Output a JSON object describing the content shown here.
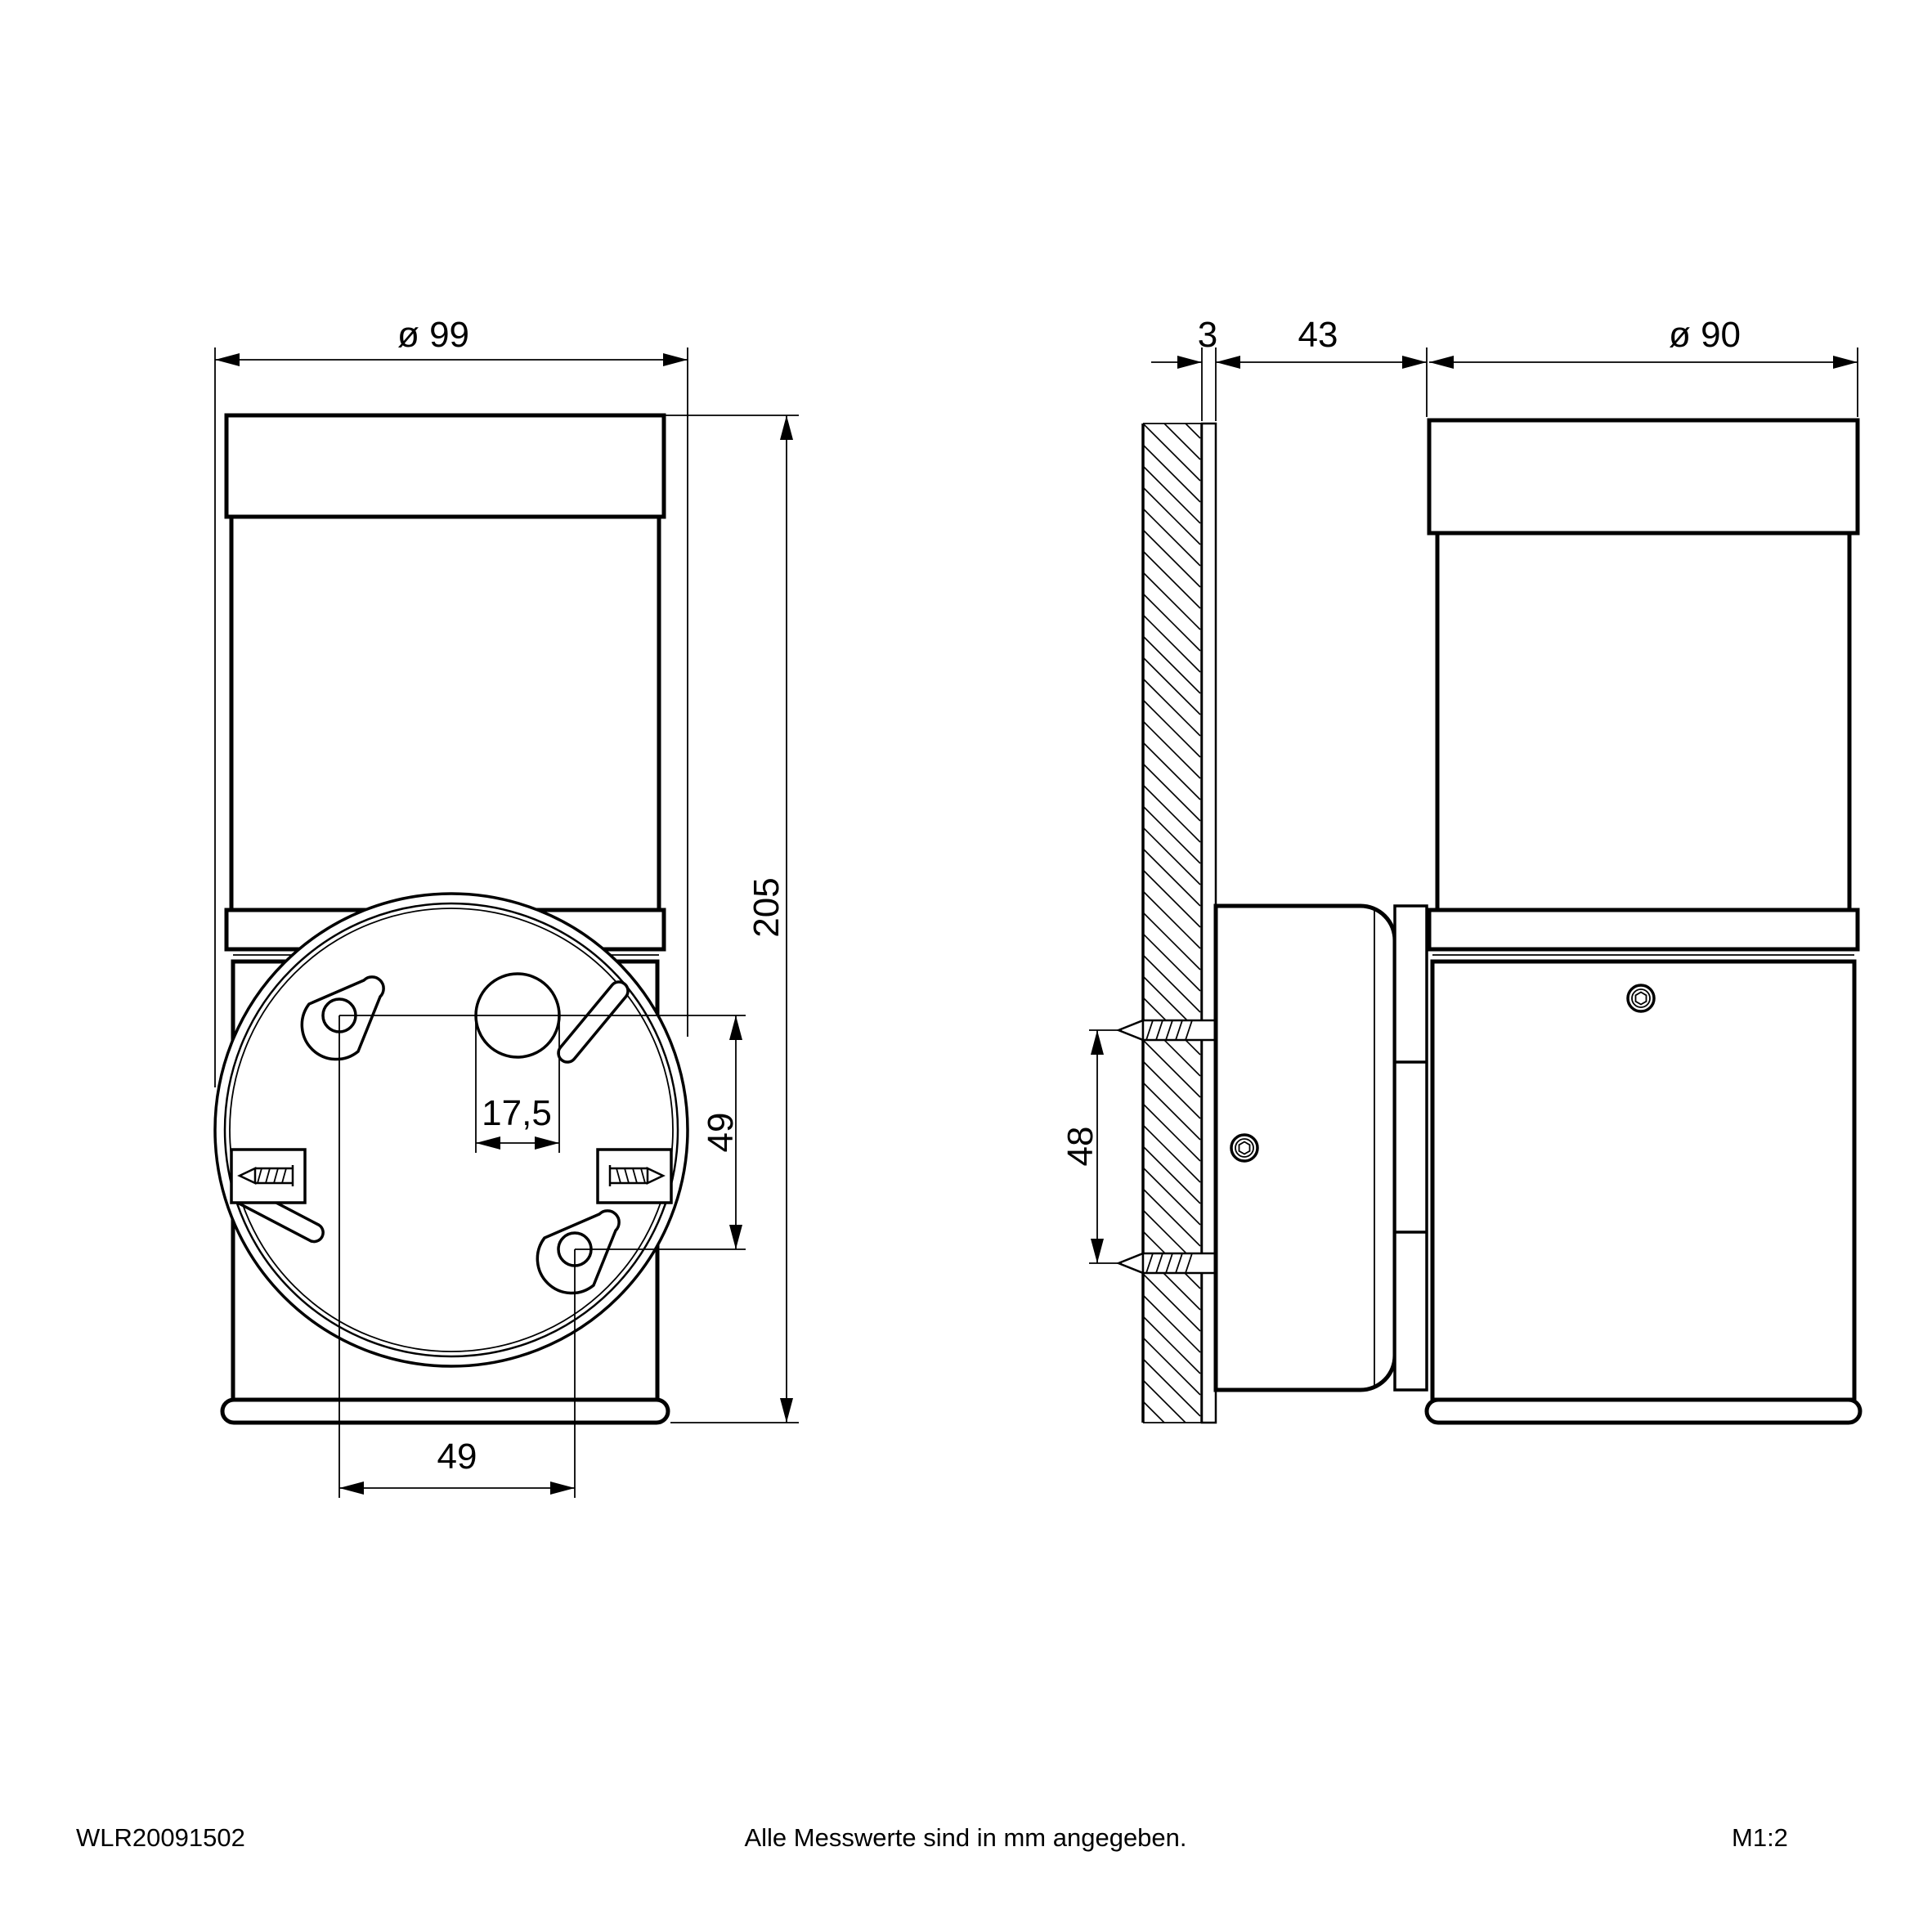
{
  "colors": {
    "ink": "#000000",
    "paper": "#ffffff"
  },
  "front_view": {
    "dims": {
      "plate_diameter": "ø 99",
      "height": "205",
      "cable_hole_diameter": "17,5",
      "keyhole_spacing_vertical": "49",
      "keyhole_spacing_horizontal": "49"
    }
  },
  "side_view": {
    "dims": {
      "backplate_thickness": "3",
      "box_depth": "43",
      "lamp_diameter": "ø 90",
      "screw_spacing": "48"
    }
  },
  "footer": {
    "article_number": "WLR20091502",
    "note": "Alle Messwerte sind in mm angegeben.",
    "scale": "M1:2"
  }
}
